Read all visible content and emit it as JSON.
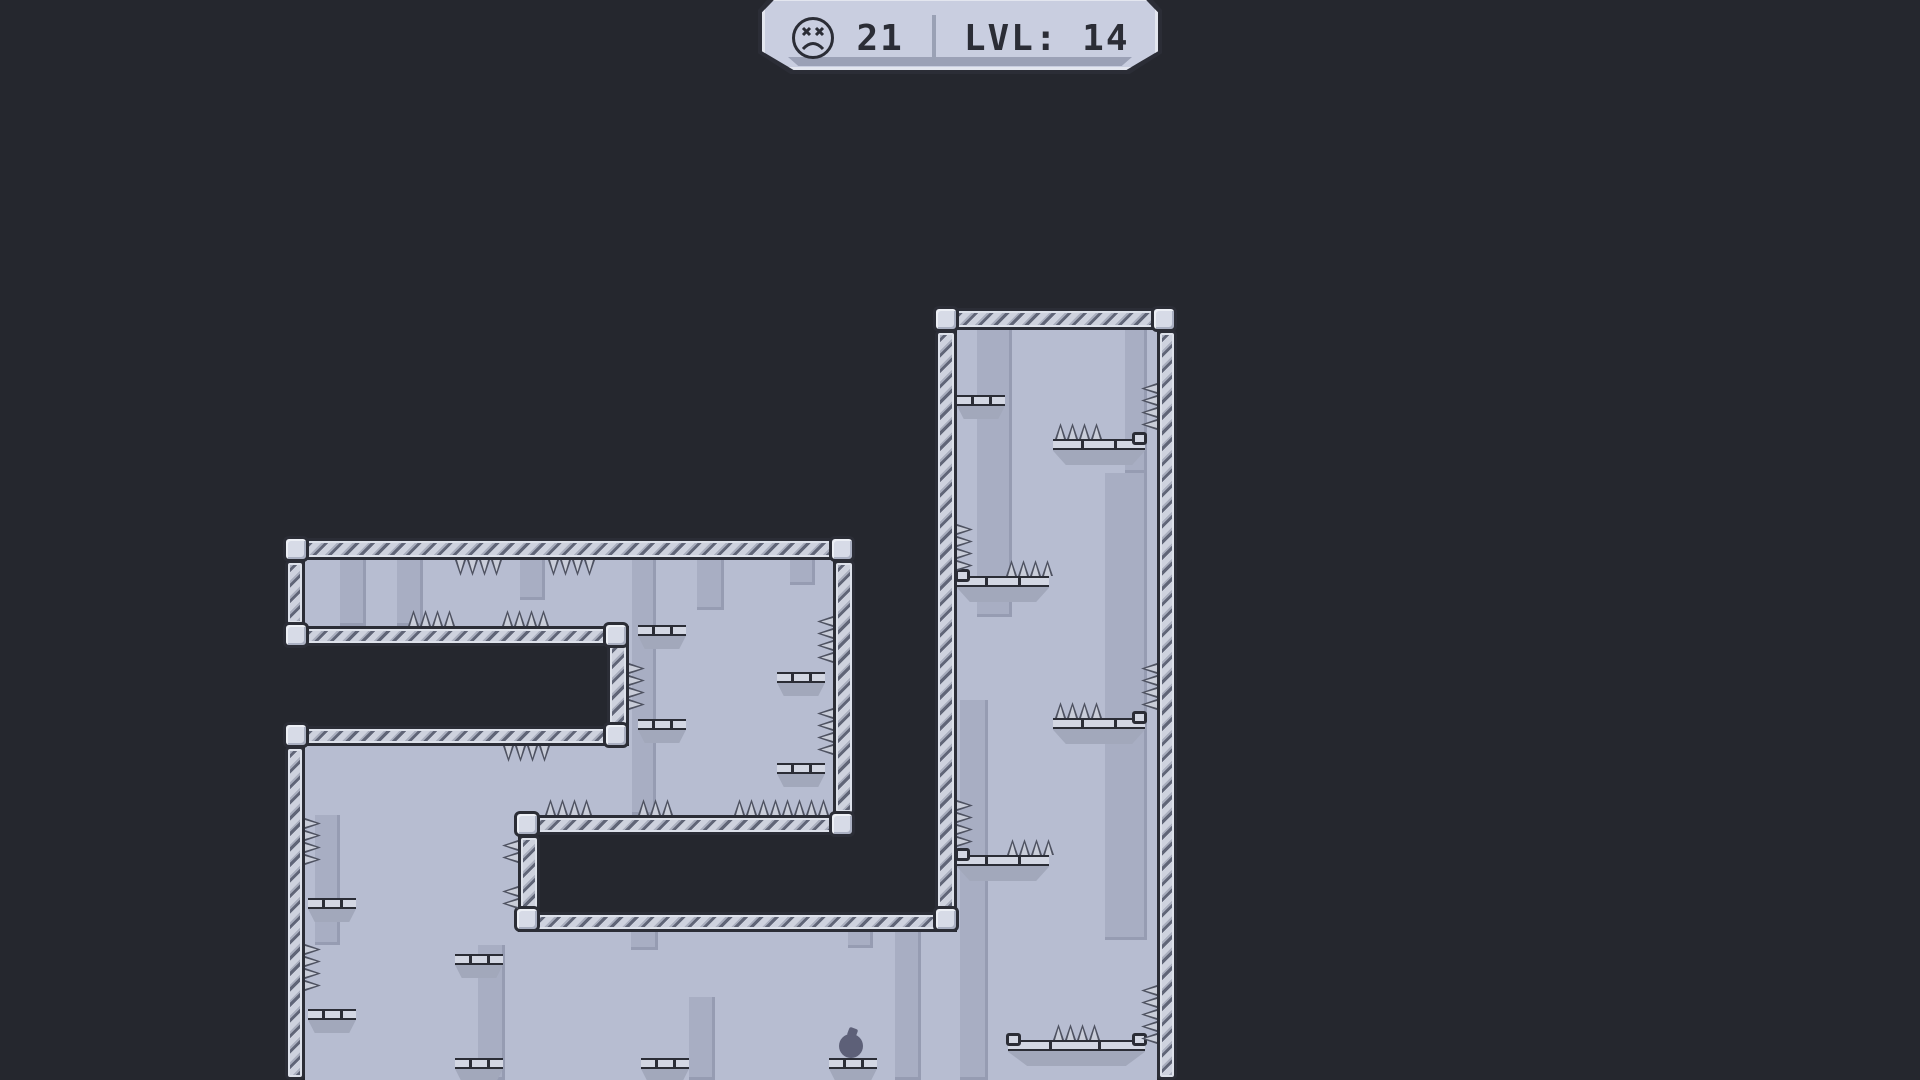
{
  "hud": {
    "deaths": "21",
    "level": "LVL: 14",
    "icon": "dead-face-icon"
  },
  "player": {
    "x": 839,
    "y": 1034,
    "size": 24
  },
  "colors": {
    "bg": "#25272e",
    "interior": "#b7bdd1",
    "strip": "#a8aec3",
    "stripEdge": "#969cb2",
    "wallLight": "#ced2de",
    "wallMid": "#a9aebe",
    "wallDark": "#606577",
    "outline": "#2b2d36",
    "capFill": "#d7dbe7",
    "platHull": "#a2a8bb",
    "platSlab": "#d3d7e3",
    "spikeFill": "#c9cdd9",
    "spikeEdge": "#4e5261",
    "player": "#5d6078",
    "hudFill": "#c9cee0",
    "hudBand": "#9ba1b6",
    "hudInk": "#2b2d36",
    "hudDivider": "#9aa1b5"
  },
  "level": {
    "interiors": [
      [
        305,
        560,
        528,
        66
      ],
      [
        629,
        560,
        204,
        255
      ],
      [
        305,
        746,
        528,
        69
      ],
      [
        305,
        815,
        213,
        265
      ],
      [
        305,
        932,
        852,
        148
      ],
      [
        957,
        330,
        200,
        750
      ]
    ],
    "strips": [
      [
        340,
        560,
        26,
        66
      ],
      [
        397,
        560,
        26,
        66
      ],
      [
        520,
        560,
        25,
        40
      ],
      [
        697,
        560,
        27,
        50
      ],
      [
        790,
        560,
        25,
        25
      ],
      [
        632,
        560,
        24,
        255
      ],
      [
        315,
        815,
        25,
        130
      ],
      [
        478,
        945,
        27,
        135
      ],
      [
        689,
        997,
        26,
        83
      ],
      [
        631,
        932,
        27,
        18
      ],
      [
        848,
        932,
        25,
        16
      ],
      [
        895,
        932,
        26,
        148
      ],
      [
        977,
        330,
        35,
        287
      ],
      [
        1125,
        330,
        22,
        143
      ],
      [
        1105,
        473,
        42,
        467
      ],
      [
        960,
        700,
        28,
        380
      ]
    ],
    "walls": [
      [
        285,
        538,
        570,
        22
      ],
      [
        285,
        560,
        20,
        66
      ],
      [
        285,
        626,
        344,
        20
      ],
      [
        607,
        626,
        22,
        120
      ],
      [
        285,
        726,
        344,
        20
      ],
      [
        285,
        746,
        20,
        334
      ],
      [
        833,
        560,
        22,
        255
      ],
      [
        518,
        815,
        337,
        20
      ],
      [
        518,
        835,
        22,
        77
      ],
      [
        518,
        912,
        439,
        20
      ],
      [
        935,
        308,
        242,
        22
      ],
      [
        935,
        330,
        22,
        582
      ],
      [
        1157,
        330,
        20,
        750
      ]
    ],
    "caps": [
      [
        283,
        536
      ],
      [
        829,
        536
      ],
      [
        283,
        622
      ],
      [
        603,
        622
      ],
      [
        603,
        722
      ],
      [
        283,
        722
      ],
      [
        829,
        811
      ],
      [
        514,
        811
      ],
      [
        514,
        906
      ],
      [
        933,
        306
      ],
      [
        1151,
        306
      ],
      [
        933,
        906
      ]
    ],
    "platforms": [
      {
        "x": 957,
        "y": 395,
        "w": 48,
        "type": "small",
        "lip": "none"
      },
      {
        "x": 638,
        "y": 625,
        "w": 48,
        "type": "small",
        "lip": "none"
      },
      {
        "x": 638,
        "y": 719,
        "w": 48,
        "type": "small",
        "lip": "none"
      },
      {
        "x": 777,
        "y": 672,
        "w": 48,
        "type": "small",
        "lip": "none"
      },
      {
        "x": 777,
        "y": 763,
        "w": 48,
        "type": "small",
        "lip": "none"
      },
      {
        "x": 308,
        "y": 898,
        "w": 48,
        "type": "small",
        "lip": "none"
      },
      {
        "x": 308,
        "y": 1009,
        "w": 48,
        "type": "small",
        "lip": "none"
      },
      {
        "x": 455,
        "y": 954,
        "w": 48,
        "type": "small",
        "lip": "none"
      },
      {
        "x": 455,
        "y": 1058,
        "w": 48,
        "type": "small",
        "lip": "none"
      },
      {
        "x": 641,
        "y": 1058,
        "w": 48,
        "type": "small",
        "lip": "none"
      },
      {
        "x": 829,
        "y": 1058,
        "w": 48,
        "type": "small",
        "lip": "none"
      },
      {
        "x": 1053,
        "y": 439,
        "w": 92,
        "type": "wide",
        "lip": "right"
      },
      {
        "x": 957,
        "y": 576,
        "w": 92,
        "type": "wide",
        "lip": "left"
      },
      {
        "x": 1053,
        "y": 718,
        "w": 92,
        "type": "wide",
        "lip": "right"
      },
      {
        "x": 957,
        "y": 855,
        "w": 92,
        "type": "wide",
        "lip": "left"
      },
      {
        "x": 1008,
        "y": 1040,
        "w": 137,
        "type": "wide",
        "lip": "both"
      }
    ],
    "spikes": [
      {
        "x": 455,
        "y": 560,
        "dir": "down",
        "n": 4
      },
      {
        "x": 548,
        "y": 560,
        "dir": "down",
        "n": 4
      },
      {
        "x": 408,
        "y": 610,
        "dir": "up",
        "n": 4
      },
      {
        "x": 502,
        "y": 610,
        "dir": "up",
        "n": 4
      },
      {
        "x": 503,
        "y": 746,
        "dir": "down",
        "n": 4
      },
      {
        "x": 629,
        "y": 663,
        "dir": "right",
        "n": 4
      },
      {
        "x": 817,
        "y": 616,
        "dir": "left",
        "n": 4
      },
      {
        "x": 817,
        "y": 708,
        "dir": "left",
        "n": 4
      },
      {
        "x": 545,
        "y": 799,
        "dir": "up",
        "n": 4
      },
      {
        "x": 638,
        "y": 799,
        "dir": "up",
        "n": 3
      },
      {
        "x": 734,
        "y": 799,
        "dir": "up",
        "n": 8
      },
      {
        "x": 502,
        "y": 840,
        "dir": "left",
        "n": 2
      },
      {
        "x": 502,
        "y": 886,
        "dir": "left",
        "n": 2
      },
      {
        "x": 305,
        "y": 818,
        "dir": "right",
        "n": 4
      },
      {
        "x": 305,
        "y": 944,
        "dir": "right",
        "n": 4
      },
      {
        "x": 957,
        "y": 524,
        "dir": "right",
        "n": 4
      },
      {
        "x": 957,
        "y": 800,
        "dir": "right",
        "n": 4
      },
      {
        "x": 1141,
        "y": 383,
        "dir": "left",
        "n": 4
      },
      {
        "x": 1141,
        "y": 663,
        "dir": "left",
        "n": 4
      },
      {
        "x": 1141,
        "y": 985,
        "dir": "left",
        "n": 5
      },
      {
        "x": 1055,
        "y": 423,
        "dir": "up",
        "n": 4
      },
      {
        "x": 1006,
        "y": 560,
        "dir": "up",
        "n": 4
      },
      {
        "x": 1055,
        "y": 702,
        "dir": "up",
        "n": 4
      },
      {
        "x": 1007,
        "y": 839,
        "dir": "up",
        "n": 4
      },
      {
        "x": 1053,
        "y": 1024,
        "dir": "up",
        "n": 4
      }
    ]
  }
}
